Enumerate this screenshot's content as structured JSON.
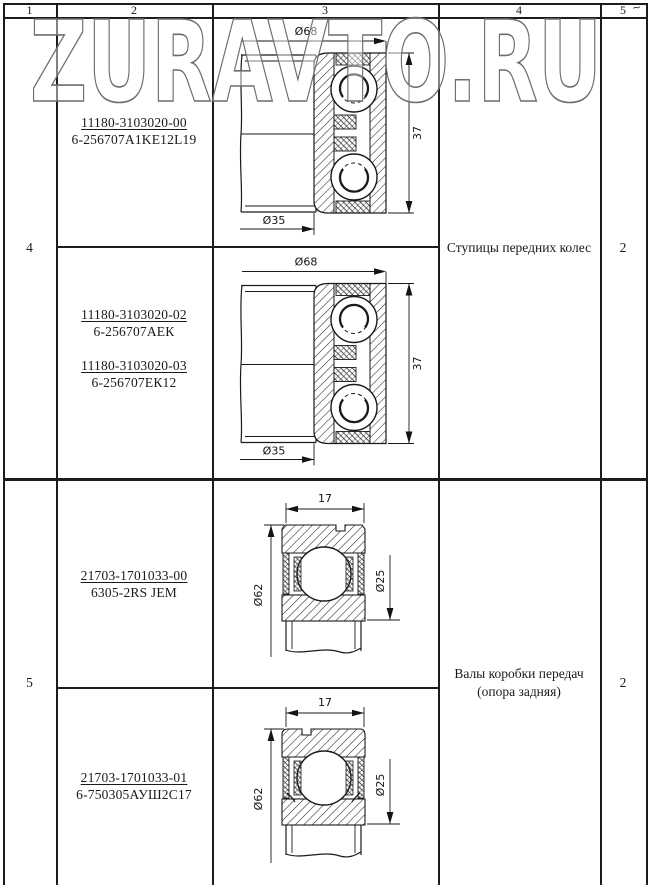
{
  "watermark": {
    "text": "ZURAVTO.RU"
  },
  "corner_mark": "~",
  "header": {
    "cols": [
      "1",
      "2",
      "3",
      "4",
      "5"
    ]
  },
  "rows": {
    "r4": {
      "no": "4",
      "app_line1": "Ступицы передних колес",
      "app_line2": "",
      "qty": "2",
      "sub1": {
        "parts": [
          {
            "num": "11180-3103020-00",
            "code": "6-256707A1KE12L19"
          }
        ],
        "dims": {
          "outer": "Ø68",
          "bore": "Ø35",
          "width": "37"
        }
      },
      "sub2": {
        "parts": [
          {
            "num": "11180-3103020-02",
            "code": "6-256707АЕК"
          },
          {
            "num": "11180-3103020-03",
            "code": "6-256707ЕК12"
          }
        ],
        "dims": {
          "outer": "Ø68",
          "bore": "Ø35",
          "width": "37"
        }
      }
    },
    "r5": {
      "no": "5",
      "app_line1": "Валы коробки передач",
      "app_line2": "(опора задняя)",
      "qty": "2",
      "sub1": {
        "parts": [
          {
            "num": "21703-1701033-00",
            "code": "6305-2RS JEM"
          }
        ],
        "dims": {
          "width": "17",
          "outer": "Ø62",
          "bore": "Ø25"
        }
      },
      "sub2": {
        "parts": [
          {
            "num": "21703-1701033-01",
            "code": "6-750305АУШ2С17"
          }
        ],
        "dims": {
          "width": "17",
          "outer": "Ø62",
          "bore": "Ø25"
        }
      }
    }
  }
}
